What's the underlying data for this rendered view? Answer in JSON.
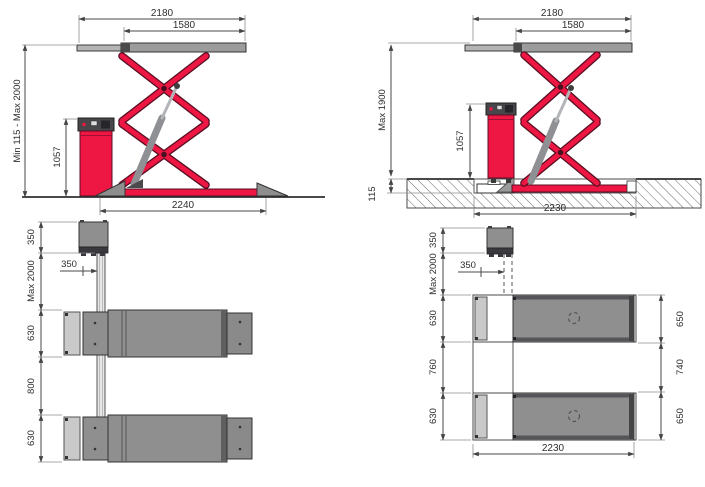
{
  "colors": {
    "accent_red": "#ee1744",
    "arm_outline": "#5a0e22",
    "steel_gray": "#9c9c9c",
    "plan_gray": "#8f8f8f",
    "ramp_light": "#c9c9c9",
    "panel_dark": "#46464b",
    "dim_line": "#4a4a4a",
    "text_color": "#2e2e2e"
  },
  "views": {
    "side_floor": {
      "overall_width": "2180",
      "platform_length": "1580",
      "height_range": "Min 115 - Max 2000",
      "console_height": "1057",
      "base_length": "2240"
    },
    "side_recessed": {
      "overall_width": "2180",
      "platform_length": "1580",
      "max_height": "Max 1900",
      "console_height": "1057",
      "recess_depth": "115",
      "base_length": "2230"
    },
    "plan_floor": {
      "console_depth": "350",
      "console_offset": "350",
      "drive_length": "Max 2000",
      "track_width_front": "630",
      "track_gap": "800",
      "track_width_rear": "630"
    },
    "plan_recessed": {
      "console_depth": "350",
      "console_offset": "350",
      "drive_length": "Max 2000",
      "track_width_front": "630",
      "track_gap": "760",
      "track_width_rear": "630",
      "outer_width_front": "650",
      "outer_gap": "740",
      "outer_width_rear": "650",
      "pit_length": "2230"
    }
  }
}
